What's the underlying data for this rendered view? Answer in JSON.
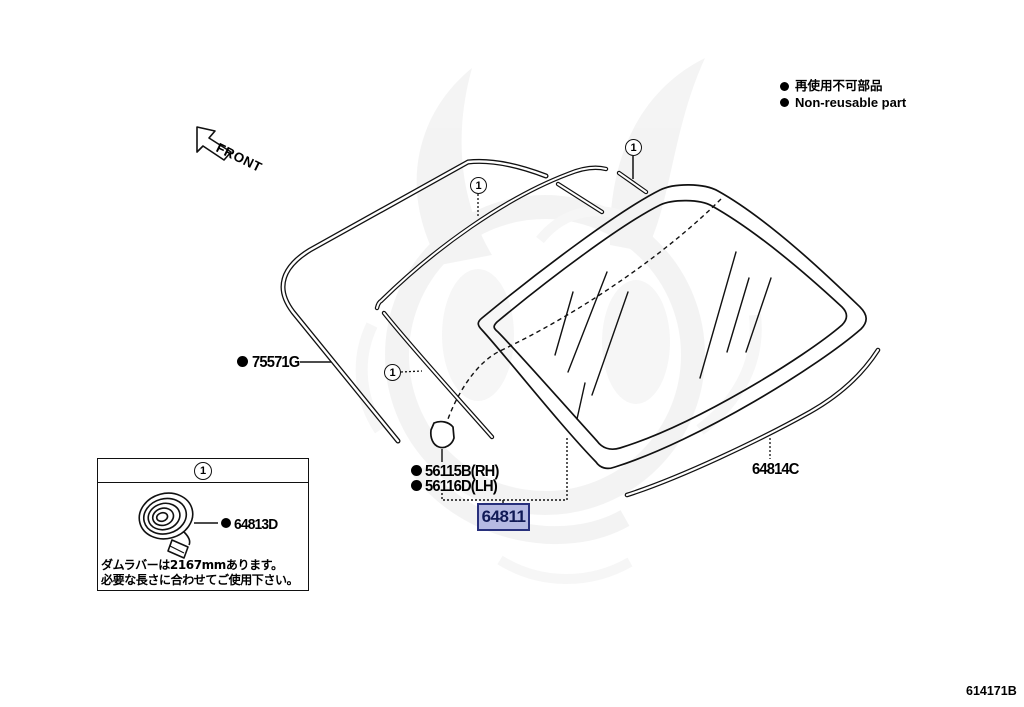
{
  "legend": {
    "jp": "再使用不可部品",
    "en": "Non-reusable part"
  },
  "orientation": {
    "front_label": "FRONT"
  },
  "callout_number": "1",
  "labels": {
    "molding_side": "75571G",
    "clip_rh": "56115B(RH)",
    "clip_lh": "56116D(LH)",
    "back_glass": "64811",
    "molding_lower": "64814C"
  },
  "inset": {
    "callout": "1",
    "dam_label": "64813D",
    "note_line1": "ダムラバーは2167mmあります。",
    "note_line2": "必要な長さに合わせてご使用下さい。"
  },
  "highlight": {
    "bg": "#b6bae3",
    "border": "#28307c",
    "text_color": "#111a56",
    "style": "background:#b6bae3;border:2px solid #28307c;color:#111a56;"
  },
  "footer": {
    "drawing_id": "614171B"
  }
}
